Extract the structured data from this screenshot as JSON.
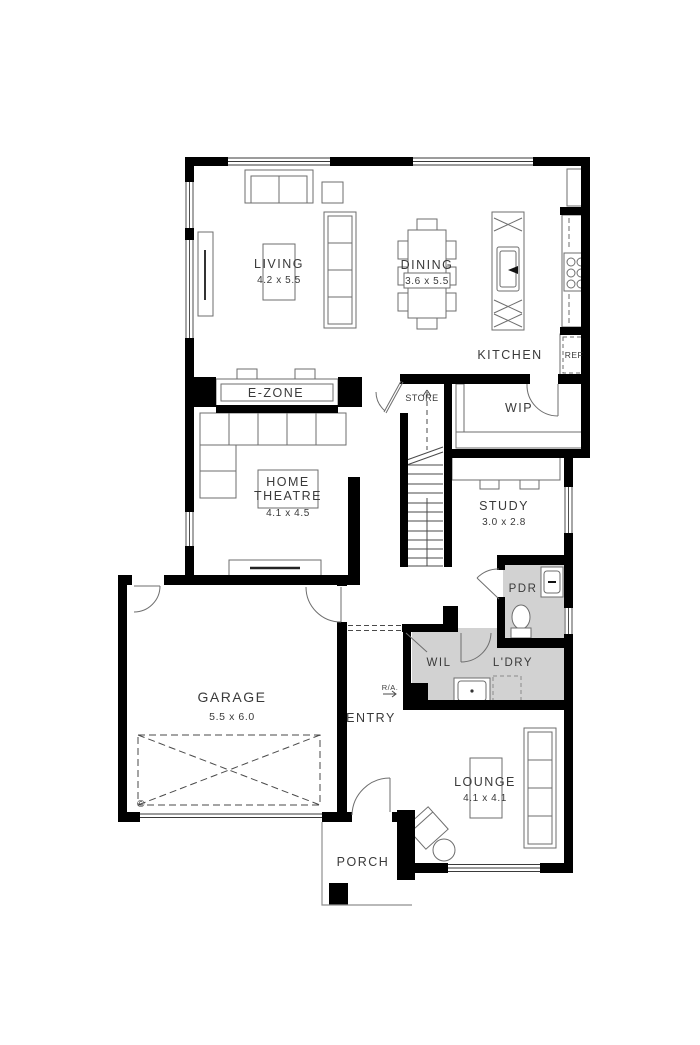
{
  "plan": {
    "type": "residential-floor-plan",
    "rooms": {
      "living": {
        "name": "LIVING",
        "dims": "4.2 x 5.5"
      },
      "dining": {
        "name": "DINING",
        "dims": "3.6 x 5.5"
      },
      "kitchen": {
        "name": "KITCHEN"
      },
      "ref": {
        "name": "REF"
      },
      "ezone": {
        "name": "E-ZONE"
      },
      "store": {
        "name": "STORE"
      },
      "wip": {
        "name": "WIP"
      },
      "home_theatre": {
        "name_lines": [
          "HOME",
          "THEATRE"
        ],
        "dims": "4.1 x 4.5"
      },
      "study": {
        "name": "STUDY",
        "dims": "3.0 x 2.8"
      },
      "pdr": {
        "name": "PDR"
      },
      "wil": {
        "name": "WIL"
      },
      "ldry": {
        "name": "L'DRY"
      },
      "garage": {
        "name": "GARAGE",
        "dims": "5.5 x 6.0"
      },
      "entry": {
        "name": "ENTRY"
      },
      "lounge": {
        "name": "LOUNGE",
        "dims": "4.1 x 4.1"
      },
      "porch": {
        "name": "PORCH"
      }
    },
    "annotations": {
      "return_air": "R/A.",
      "copyright": "©"
    },
    "colors": {
      "wall": "#000000",
      "wet_area_floor": "#d2d2d2",
      "furniture_line": "#6e6e6e",
      "text": "#3a3a3a",
      "background": "#ffffff"
    }
  }
}
